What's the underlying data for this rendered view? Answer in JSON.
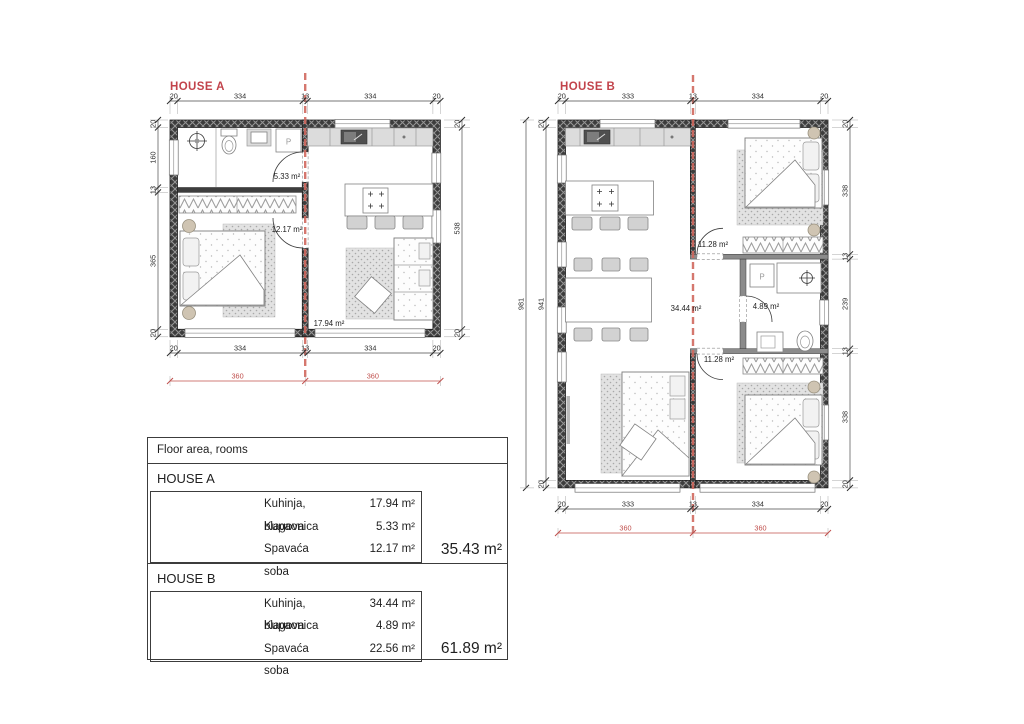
{
  "colors": {
    "accent_red": "#c2434b",
    "dim_red": "#c0504d"
  },
  "house_a": {
    "title": "HOUSE A",
    "washer_label": "P",
    "rooms": {
      "bath": "5.33 m²",
      "bedroom": "12.17 m²",
      "kitchen": "17.94 m²"
    },
    "dims": {
      "top": [
        "20",
        "334",
        "13",
        "334",
        "20"
      ],
      "bottom": [
        "20",
        "334",
        "13",
        "334",
        "20"
      ],
      "left": [
        "20",
        "160",
        "13",
        "365",
        "20"
      ],
      "right": [
        "20",
        "538",
        "20"
      ],
      "bottom_red": [
        "360",
        "360"
      ]
    }
  },
  "house_b": {
    "title": "HOUSE B",
    "washer_label": "P",
    "rooms": {
      "kitchen": "34.44 m²",
      "bedroom_top": "11.28 m²",
      "bath": "4.89 m²",
      "bedroom_bottom": "11.28 m²"
    },
    "dims": {
      "top": [
        "20",
        "333",
        "13",
        "334",
        "20"
      ],
      "bottom": [
        "20",
        "333",
        "13",
        "334",
        "20"
      ],
      "left_outer": "981",
      "left": [
        "20",
        "941",
        "20"
      ],
      "right": [
        "20",
        "338",
        "13",
        "239",
        "13",
        "338",
        "20"
      ],
      "bottom_red": [
        "360",
        "360"
      ]
    }
  },
  "table": {
    "header": "Floor area, rooms",
    "sections": [
      {
        "name": "HOUSE A",
        "rows": [
          [
            "Kuhinja, blagova",
            "17.94 m²"
          ],
          [
            "Kupaonica",
            "5.33 m²"
          ],
          [
            "Spavaća soba",
            "12.17 m²"
          ]
        ],
        "total": "35.43 m²"
      },
      {
        "name": "HOUSE B",
        "rows": [
          [
            "Kuhinja, blagova",
            "34.44 m²"
          ],
          [
            "Kupaonica",
            "4.89 m²"
          ],
          [
            "Spavaća soba",
            "22.56 m²"
          ]
        ],
        "total": "61.89 m²"
      }
    ]
  }
}
